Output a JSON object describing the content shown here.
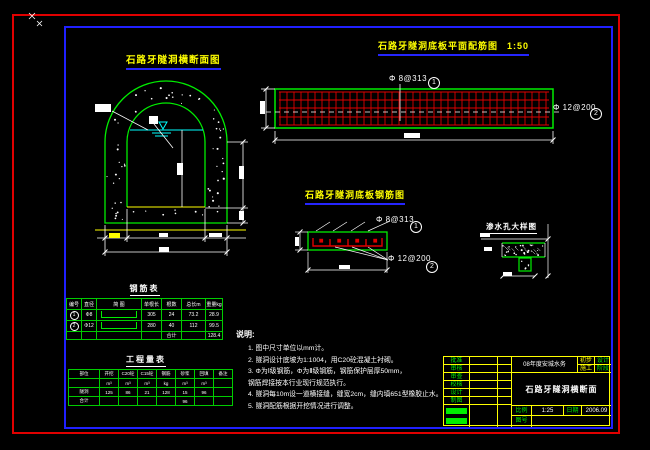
{
  "colors": {
    "line_green": "#00ee00",
    "mesh_red": "#e00000",
    "frame_red": "#e00000",
    "frame_blue": "#2020ff",
    "accent_yellow": "#ffff00",
    "water_cyan": "#00ffff",
    "text_white": "#ffffff"
  },
  "titles": {
    "cross_section": "石路牙隧洞横断面图",
    "plan": "石路牙隧洞底板平面配筋图",
    "plan_scale": "1:50",
    "slab_section": "石路牙隧洞底板钢筋图",
    "weep_detail": "渗水孔大样图"
  },
  "rebar_labels": {
    "bar1": "Φ 8@313",
    "bar1_no": "1",
    "bar2": "Φ 12@200",
    "bar2_no": "2"
  },
  "rebar_table": {
    "title": "钢筋表",
    "headers": [
      "编号",
      "直径",
      "简  图",
      "单根长",
      "根数",
      "总长m",
      "重量kg"
    ],
    "rows": [
      {
        "no": "1",
        "dia": "Φ8",
        "len": "305",
        "count": "24",
        "total": "73.2",
        "weight": "28.9"
      },
      {
        "no": "2",
        "dia": "Φ12",
        "len": "280",
        "count": "40",
        "total": "112",
        "weight": "99.5"
      }
    ],
    "footer_label": "合计",
    "footer_value": "128.4"
  },
  "quantity_table": {
    "title": "工程量表",
    "headers": [
      "部位",
      "开挖",
      "C20砼",
      "C15砼",
      "钢筋",
      "砂浆",
      "回填",
      "备注"
    ],
    "units": [
      "",
      "m³",
      "m³",
      "m³",
      "kg",
      "m³",
      "m³",
      ""
    ],
    "values": [
      "隧洞",
      "125",
      "86",
      "21",
      "128",
      "15",
      "96",
      ""
    ],
    "totals": [
      "合计",
      "",
      "",
      "",
      "",
      "96",
      "",
      ""
    ]
  },
  "notes": {
    "heading": "说明:",
    "lines": [
      "1. 图中尺寸单位以mm计。",
      "2. 隧洞设计底坡为1:1004，用C20砼混凝土衬砌。",
      "3. Φ为Ⅰ级钢筋，Φ为Ⅱ级钢筋，钢筋保护层厚50mm，",
      "钢筋焊接按本行业现行规范执行。",
      "4. 隧洞每10m设一道横接缝，缝宽2cm，缝内填651型橡胶止水。",
      "5. 隧洞配筋根据开挖情况进行调整。"
    ]
  },
  "title_block": {
    "row_labels": [
      "批准",
      "审核",
      "审查",
      "校核",
      "设计",
      "制图"
    ],
    "project": "08年度安城水务",
    "stage_rows": [
      [
        "初步",
        "设计"
      ],
      [
        "施工",
        "阶段"
      ]
    ],
    "drawing_title": "石路牙隧洞横断面",
    "scale_label": "比例",
    "scale_value": "1:25",
    "date_label": "日期",
    "date_value": "2006.09",
    "no_label": "图号",
    "no_value": ""
  }
}
